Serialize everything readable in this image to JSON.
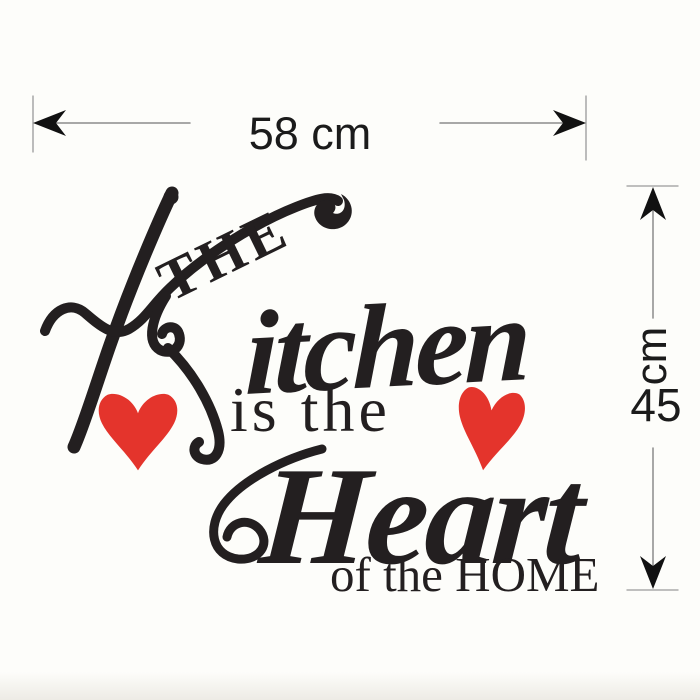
{
  "product": {
    "background": "#fdfdfa",
    "ink_color": "#231f20",
    "heart_color": "#e4342c",
    "dimension_line_color": "#8b8b8b",
    "dimension_text_color": "#1b1b1b"
  },
  "decal": {
    "word_the": "THE",
    "word_kitchen_rest": "itchen",
    "phrase_is_the": "is the",
    "word_heart": "Heart",
    "phrase_of_the_home": "of the HOME"
  },
  "dimensions": {
    "width_label": "58 cm",
    "height_value": "45",
    "height_unit": "cm"
  }
}
